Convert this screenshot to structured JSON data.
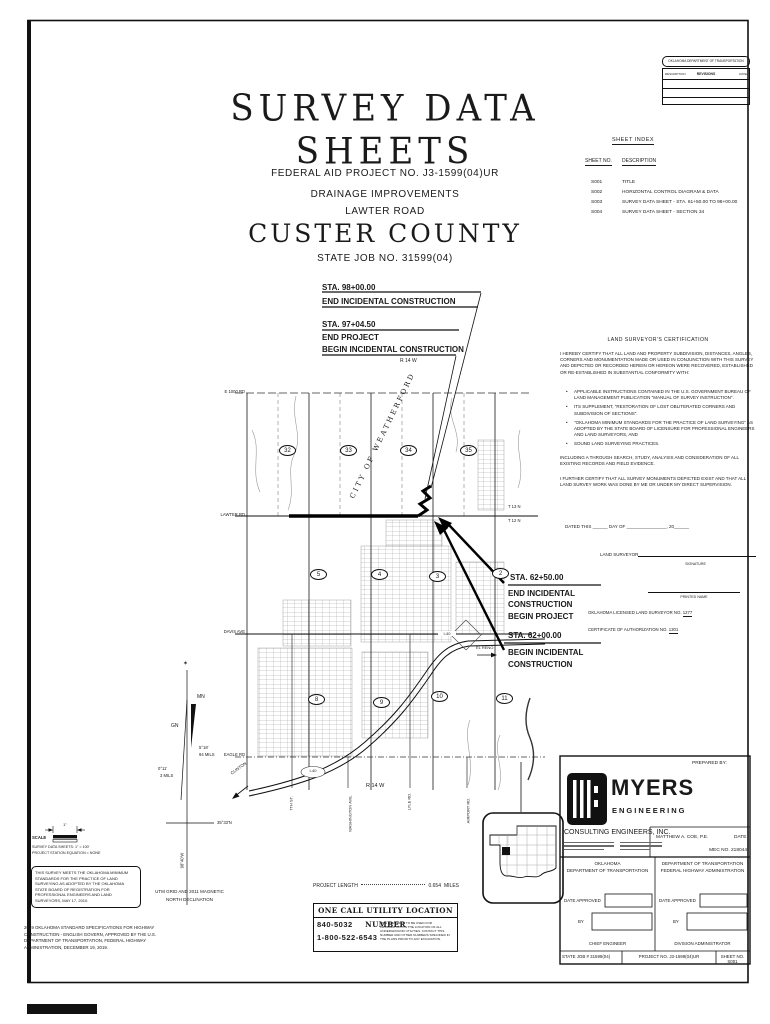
{
  "revision_block": {
    "agency": "OKLAHOMA DEPARTMENT OF TRANSPORTATION",
    "col_description": "DESCRIPTION",
    "col_revisions": "REVISIONS",
    "col_date": "DATE"
  },
  "title_block": {
    "main_title": "SURVEY DATA SHEETS",
    "federal_aid": "FEDERAL AID PROJECT NO. J3-1599(04)UR",
    "improvement": "DRAINAGE IMPROVEMENTS",
    "road": "LAWTER ROAD",
    "county": "CUSTER COUNTY",
    "state_job": "STATE JOB NO. 31599(04)"
  },
  "sheet_index": {
    "title": "SHEET INDEX",
    "col_no": "SHEET NO.",
    "col_desc": "DESCRIPTION",
    "rows": [
      [
        "S001",
        "TITLE"
      ],
      [
        "S002",
        "HORIZONTAL CONTROL DIAGRAM & DATA"
      ],
      [
        "S003",
        "SURVEY DATA SHEET - STA. 61+50.00 TO 98+00.00"
      ],
      [
        "S004",
        "SURVEY DATA SHEET - SECTION 34"
      ]
    ]
  },
  "callouts": {
    "c1_sta": "STA. 98+00.00",
    "c1_l1": "END INCIDENTAL CONSTRUCTION",
    "c2_sta": "STA. 97+04.50",
    "c2_l1": "END PROJECT",
    "c2_l2": "BEGIN INCIDENTAL CONSTRUCTION",
    "c3_sta": "STA. 62+50.00",
    "c3_l1": "END INCIDENTAL",
    "c3_l2": "CONSTRUCTION",
    "c3_l3": "BEGIN PROJECT",
    "c4_sta": "STA. 62+00.00",
    "c4_l1": "BEGIN INCIDENTAL",
    "c4_l2": "CONSTRUCTION"
  },
  "map": {
    "road_e1000": "E 1000 RD",
    "road_lawter": "LAWTER RD",
    "road_davis": "DAVIS AVE",
    "road_eagle": "EAGLE RD",
    "city": "CITY OF WEATHERFORD",
    "t13n": "T 13 N",
    "t12n": "T 12 N",
    "r14w_top": "R 14 W",
    "r14w_bottom": "R 14 W",
    "sections_row1": [
      "32",
      "33",
      "34",
      "35"
    ],
    "sections_row2": [
      "5",
      "4",
      "3",
      "2"
    ],
    "sections_row3": [
      "8",
      "9",
      "10",
      "11"
    ],
    "el_reno": "EL RENO",
    "clinton": "CLINTON",
    "i40_a": "I-40",
    "i40_b": "I-40",
    "st_7th": "7TH ST.",
    "st_washington": "WASHINGTON AVE.",
    "st_lyle": "LYLE RD.",
    "st_airport": "AIRPORT RD."
  },
  "certification": {
    "heading": "LAND SURVEYOR'S CERTIFICATION",
    "para1": "I HEREBY CERTIFY THAT ALL LAND AND PROPERTY SUBDIVISION, DISTANCES, ANGLES, CORNERS AND MONUMENTATION MADE OR USED IN CONJUNCTION WITH THIS SURVEY AND DEPICTED OR RECORDED HEREIN OR HEREON WERE RECOVERED, ESTABLISHED OR RE-ESTABLISHED IN SUBSTANTIAL CONFORMITY WITH:",
    "bullet_marker": "•",
    "bullet1": "APPLICABLE INSTRUCTIONS CONTAINED IN THE U.S. GOVERNMENT BUREAU OF LAND MANAGEMENT PUBLICATION \"MANUAL OF SURVEY INSTRUCTION\".",
    "bullet2": "ITS SUPPLEMENT, \"RESTORATION OF LOST OBLITERATED CORNERS AND SUBDIVISION OF SECTIONS\".",
    "bullet3": "\"OKLAHOMA MINIMUM STANDARDS FOR THE PRACTICE OF LAND SURVEYING\" AS ADOPTED BY THE STATE BOARD OF LICENSURE FOR PROFESSIONAL ENGINEERS AND LAND SURVEYORS, AND",
    "bullet4": "SOUND LAND SURVEYING PRACTICES.",
    "para2": "INCLUDING A THROUGH SEARCH, STUDY, ANALYSIS AND CONSIDERATION OF ALL EXISTING RECORDS AND FIELD EVIDENCE.",
    "para3": "I FURTHER CERTIFY THAT ALL SURVEY MONUMENTS DEPICTED EXIST AND THAT ALL LAND SURVEY WORK WAS DONE BY ME OR UNDER MY DIRECT SUPERVISION.",
    "dated": "DATED THIS ______ DAY OF ________________, 20______",
    "land_surveyor": "LAND SURVEYOR",
    "signature": "SIGNATURE",
    "printed_name": "PRINTED NAME",
    "license_label": "OKLAHOMA LICENSED LAND SURVEYOR NO.",
    "license_no": "1277",
    "cert_label": "CERTIFICATE OF AUTHORIZATION NO.",
    "cert_no": "1301"
  },
  "declination": {
    "star": "✶",
    "mn": "MN",
    "gn": "GN",
    "ang1": "5°18'",
    "mils1": "94 MILS",
    "ang2": "0°11'",
    "mils2": "3 MILS",
    "lat": "35°33'N",
    "lon": "98°40'W",
    "caption1": "UTM GRID AND 2011 MAGNETIC",
    "caption2": "NORTH DECLINATION"
  },
  "scale_block": {
    "inch": "1\"",
    "scale": "SCALE",
    "line1": "SURVEY DATA SHEETS: 1\" = 100'",
    "line2": "PROJECT STATION EQUATION = NONE"
  },
  "standards_note": "THIS SURVEY MEETS THE OKLAHOMA MINIMUM STANDARDS FOR THE PRACTICE OF LAND SURVEYING AS ADOPTED BY THE OKLAHOMA STATE BOARD OF REGISTRATION FOR PROFESSIONAL ENGINEERS AND LAND SURVEYORS, MAY 17, 2010.",
  "spec_note": "2019 OKLAHOMA STANDARD SPECIFICATIONS FOR HIGHWAY CONSTRUCTION - ENGLISH GOVERN, APPROVED BY THE U.S. DEPARTMENT OF TRANSPORTATION, FEDERAL HIGHWAY ADMINISTRATION, DECEMBER 19, 2019.",
  "project_length": {
    "label": "PROJECT LENGTH",
    "value": "0.654",
    "unit": "MILES"
  },
  "one_call": {
    "title": "ONE CALL UTILITY LOCATION NUMBER",
    "phone1": "840-5032",
    "phone2": "1-800-522-6543",
    "note": "THIS NUMBER IS TO BE USED FOR INFORMATION ON THE LOCATION OF ALL UNDERGROUND UTILITIES. CONTACT THIS NUMBER AND OTHER NUMBERS SPECIFIED IN THE PLANS PRIOR TO ANY EXCAVATION."
  },
  "firm": {
    "prepared_by": "PREPARED BY:",
    "name": "MYERS",
    "sub": "ENGINEERING",
    "company": "CONSULTING ENGINEERS, INC.",
    "engineer": "MATTHEW A. COE, P.E.",
    "date_label": "DATE",
    "misc": "MEC NO. 218044"
  },
  "approvals": {
    "left_line1": "OKLAHOMA",
    "left_line2": "DEPARTMENT OF TRANSPORTATION",
    "left_date": "DATE APPROVED",
    "left_by": "BY",
    "left_role": "CHIEF ENGINEER",
    "right_line1": "DEPARTMENT OF TRANSPORTATION",
    "right_line2": "FEDERAL HIGHWAY ADMINISTRATION",
    "right_date": "DATE APPROVED",
    "right_by": "BY",
    "right_role": "DIVISION ADMINISTRATOR",
    "state_job": "STATE JOB # 31599(04)",
    "project_no": "PROJECT NO. J3-1599(04)UR",
    "sheet_no": "SHEET NO. S001"
  }
}
